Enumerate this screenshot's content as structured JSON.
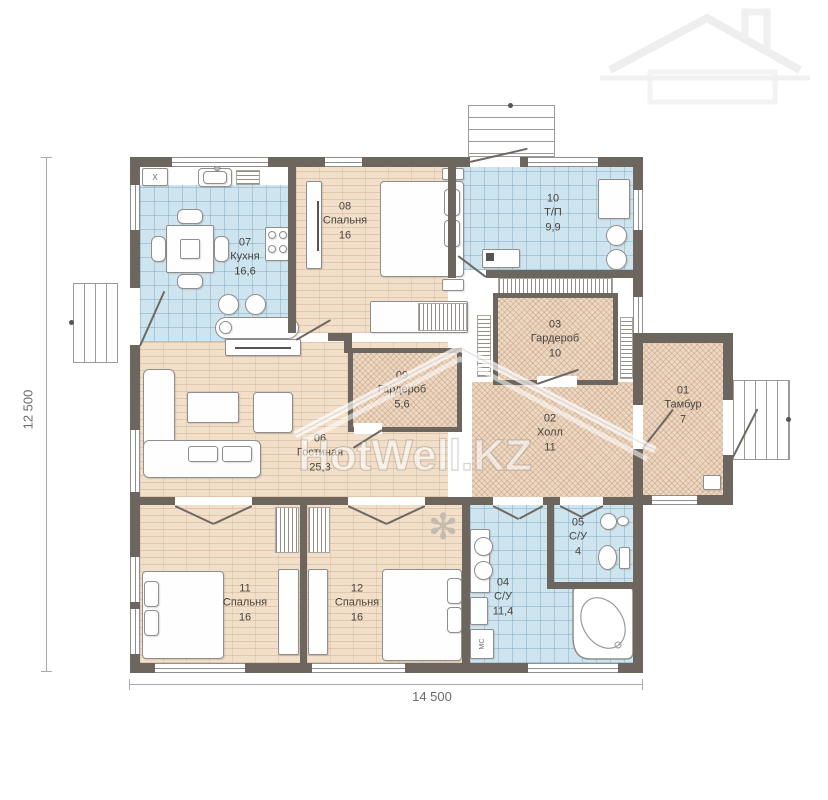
{
  "document": {
    "type": "floor-plan"
  },
  "watermark": {
    "text": "HotWell.KZ"
  },
  "dimensions": {
    "height_label": "12 500",
    "width_label": "14 500"
  },
  "rooms": [
    {
      "number": "01",
      "name": "Тамбур",
      "area": "7"
    },
    {
      "number": "02",
      "name": "Холл",
      "area": "11"
    },
    {
      "number": "03",
      "name": "Гардероб",
      "area": "10"
    },
    {
      "number": "04",
      "name": "С/У",
      "area": "11,4"
    },
    {
      "number": "05",
      "name": "С/У",
      "area": "4"
    },
    {
      "number": "06",
      "name": "Гостиная",
      "area": "25,3"
    },
    {
      "number": "07",
      "name": "Кухня",
      "area": "16,6"
    },
    {
      "number": "08",
      "name": "Спальня",
      "area": "16"
    },
    {
      "number": "09",
      "name": "Гардероб",
      "area": "5,6"
    },
    {
      "number": "10",
      "name": "Т/П",
      "area": "9,9"
    },
    {
      "number": "11",
      "name": "Спальня",
      "area": "16"
    },
    {
      "number": "12",
      "name": "Спальня",
      "area": "16"
    }
  ],
  "labels": {
    "washing_machine": "МС",
    "kitchen_unit": "X"
  },
  "icons": {
    "plant": "✻"
  },
  "colors": {
    "wall": "#6c665f",
    "tile_floor": "#cee4ef",
    "wood_floor": "#f2dfc9",
    "hatch_floor": "#edd8c3",
    "label_text": "#49443d",
    "watermark": "#ffffff"
  }
}
